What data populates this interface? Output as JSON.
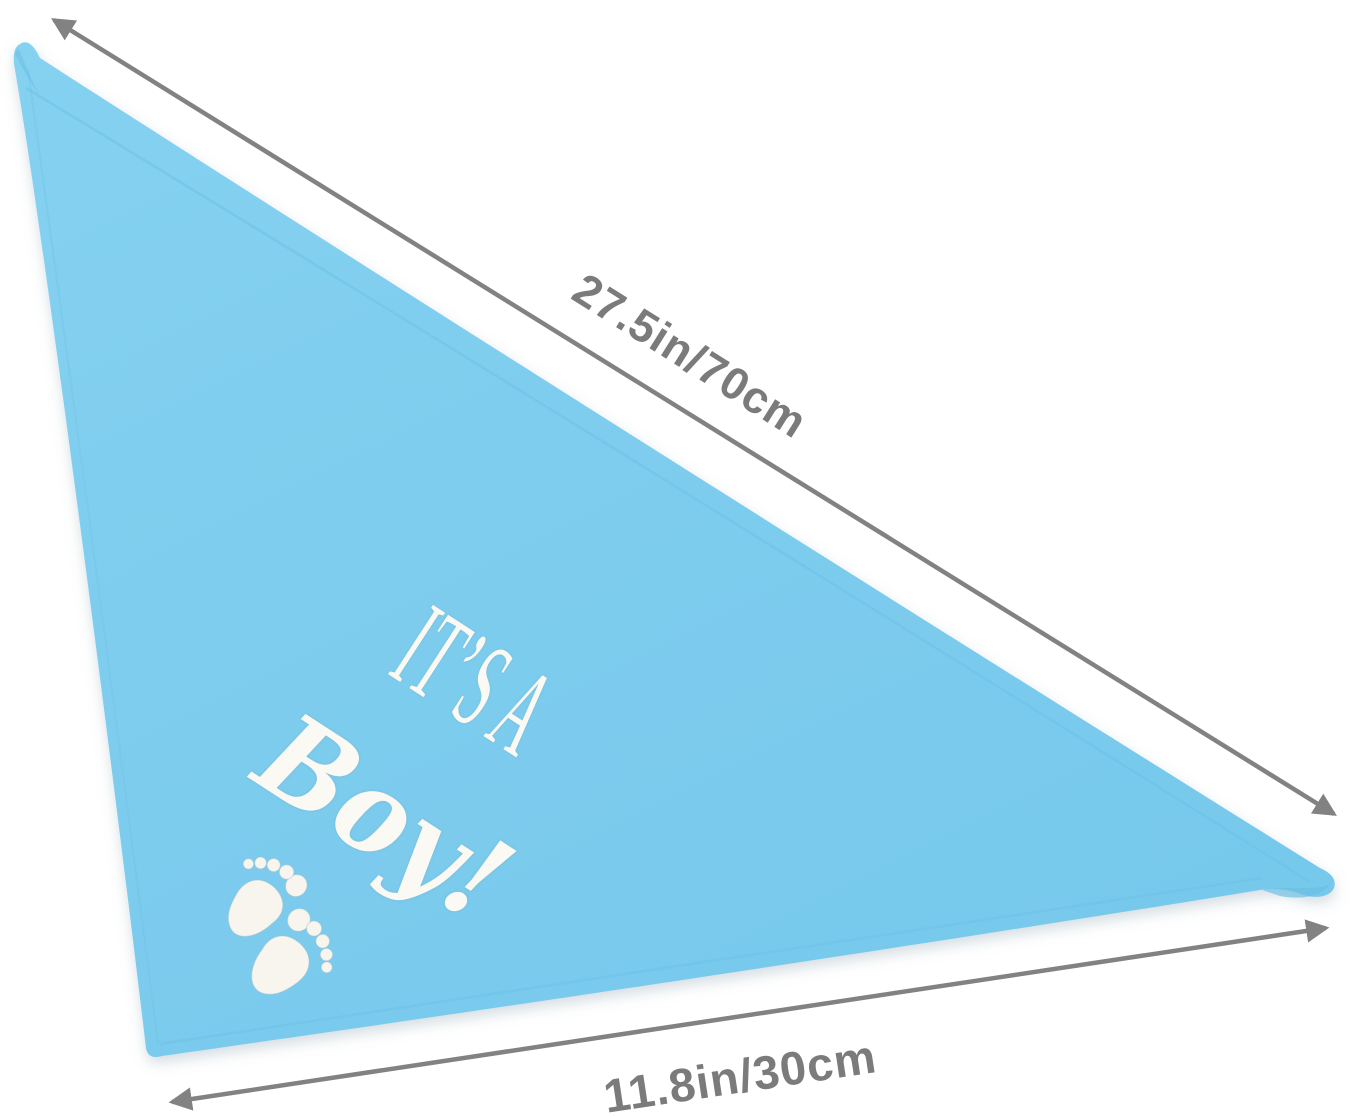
{
  "scene": {
    "type": "product photo with dimension callouts",
    "background_color": "#FFFFFF",
    "subject": "triangular baby bandana bib"
  },
  "bandana": {
    "shape": "triangle",
    "fabric_color": "#7DCCEE",
    "hem_color": "#6CC2E6",
    "design": {
      "line1": "IT’S A",
      "line2": "Boy!",
      "text_color": "#FAF9F3",
      "motif": "baby-footprints",
      "motif_color": "#F7F5EE"
    }
  },
  "dimensions": {
    "hypotenuse_label": "27.5in/70cm",
    "bottom_label": "11.8in/30cm",
    "arrow_color": "#828282",
    "label_color": "#7B7B7B"
  }
}
